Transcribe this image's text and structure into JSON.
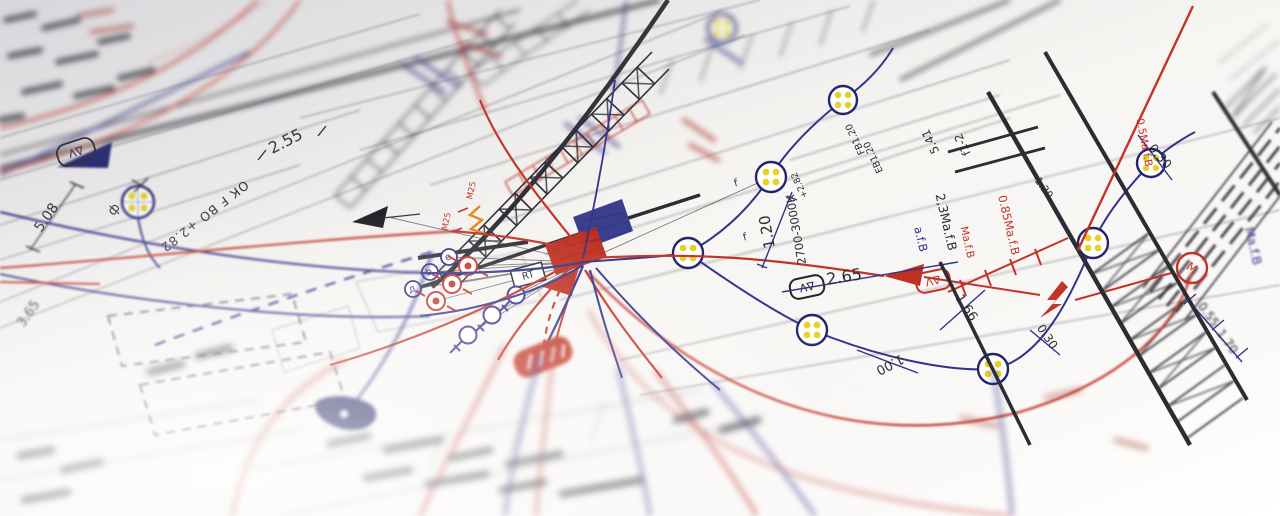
{
  "labels": {
    "dim_2_55": "2.55",
    "dim_5_08": "5.08",
    "phi": "ф",
    "ok_fbo": "ОК F ВО +2.82",
    "dim_3_65": "3.65",
    "m25": "М25",
    "rt": "RT",
    "delta_v": "ΔV",
    "dim_1_20": "1.20",
    "kelvin": "2700-3000К",
    "dim_2_65": "2.65",
    "fb": "FB1.20",
    "eb": "ЕВ1.20",
    "plus_2_82": "+2.82",
    "dim_5_41": "5.41",
    "f1_2": "f1-2",
    "ma_23": "2,3Ма.f.В",
    "afb": "а.f.В",
    "ma_085": "0.85Ма.f.В",
    "ma_05": "0.5Ма.f.В",
    "ma": "Ма.f.В",
    "dim_0_30": "0.30",
    "dim_1_66": "1.66",
    "dim_1_00": "1.00",
    "dim_0_55": "0.55",
    "dim_1_70": "1.70",
    "f": "f",
    "m_motor": "М"
  },
  "colors": {
    "paper": "#f7f5f2",
    "ink_black": "#2c2c34",
    "ink_blue": "#32338a",
    "ink_red": "#c23427",
    "dot_yellow": "#e6d227",
    "accent_orange": "#e2891c",
    "fill_blue_patch": "#3a3f8f",
    "fill_red_patch": "#bf3020"
  }
}
